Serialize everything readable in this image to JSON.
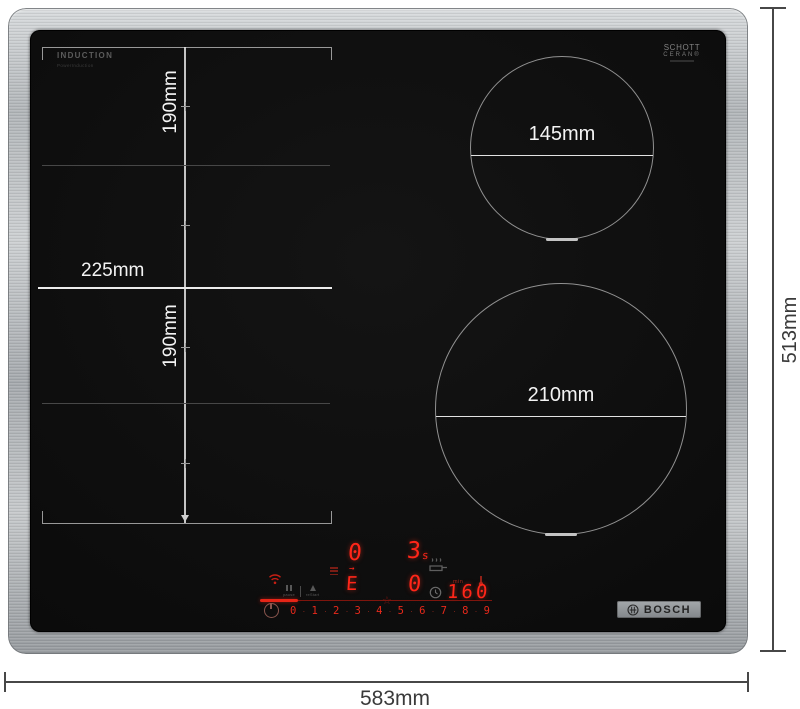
{
  "colors": {
    "led_red": "#ff2619",
    "dim_red": "#7e150d",
    "steel_gray": "#b7bbbe",
    "glass_black": "#0c0c0c"
  },
  "hob": {
    "brand": "BOSCH",
    "surface_print": {
      "induction_label": "INDUCTION",
      "induction_sublabel": "PowerInduction",
      "glass_brand_line1": "SCHOTT",
      "glass_brand_line2": "CERAN®"
    }
  },
  "annotations": {
    "overall_width": "583mm",
    "overall_depth": "513mm",
    "flex_zone_width": "225mm",
    "flex_zone_rear_depth": "190mm",
    "flex_zone_front_depth": "190mm",
    "small_zone_diameter": "145mm",
    "large_zone_diameter": "210mm"
  },
  "control_panel": {
    "zone_display_rear": "0",
    "timer_value": "3",
    "timer_unit": "s",
    "flex_display": "E",
    "flex_display_marker": "→",
    "zone_display_front": "0",
    "temp_label": "min",
    "temp_value": "160",
    "level_separator": "·",
    "power_levels": [
      "0",
      "1",
      "2",
      "3",
      "4",
      "5",
      "6",
      "7",
      "8",
      "9"
    ],
    "function_keys": [
      {
        "label": "pause"
      },
      {
        "label": "reStart"
      }
    ]
  }
}
